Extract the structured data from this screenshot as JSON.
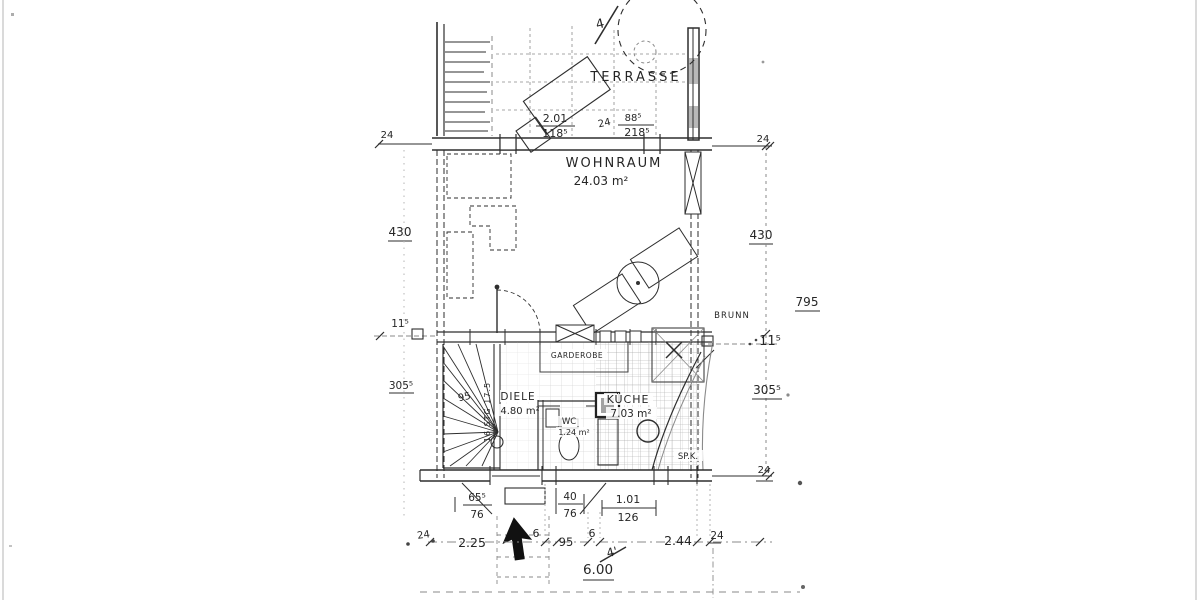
{
  "colors": {
    "ink": "#2b2b2b",
    "paper": "#ffffff",
    "faint_gray": "#8a8a8a"
  },
  "labels": {
    "terrasse": "TERRASSE",
    "wohnraum": "WOHNRAUM",
    "wohnraum_area": "24.03 m²",
    "diele": "DIELE",
    "diele_area": "4.80 m²",
    "kueche": "KÜCHE",
    "kueche_area": "7.03 m²",
    "wc": "WC",
    "wc_area": "1.24 m²",
    "garderobe": "GARDEROBE",
    "speisekammer": "SP.K.",
    "brunn": "BRUNN",
    "stair_width": "95",
    "stair_note": "16 STG 17.5"
  },
  "section_markers": {
    "top": "4",
    "bottom": "4'"
  },
  "dimensions": {
    "terrace": {
      "left_top": "2.01",
      "left_bottom": "118⁵",
      "gap": "24",
      "right_top": "88⁵",
      "right_bottom": "218⁵"
    },
    "front_wall": {
      "left": "24",
      "right": "24"
    },
    "middle": {
      "left_height": "430",
      "right_height": "430",
      "right_total": "795",
      "sill_left": "11⁵",
      "sill_right": "11⁵"
    },
    "lower": {
      "left_height": "305⁵",
      "right_height": "305⁵",
      "bottom_right_wall": "24"
    },
    "entry": {
      "d1_top": "65⁵",
      "d1_bottom": "76",
      "d2_top": "40",
      "d2_bottom": "76",
      "d3_top": "1.01",
      "d3_bottom": "126"
    },
    "bottom_chain": {
      "c1": "24",
      "c2": "2.25",
      "c3": "6",
      "c4": "95",
      "c5": "6",
      "c6": "2.44",
      "c7": "24"
    },
    "total_width": "6.00"
  }
}
